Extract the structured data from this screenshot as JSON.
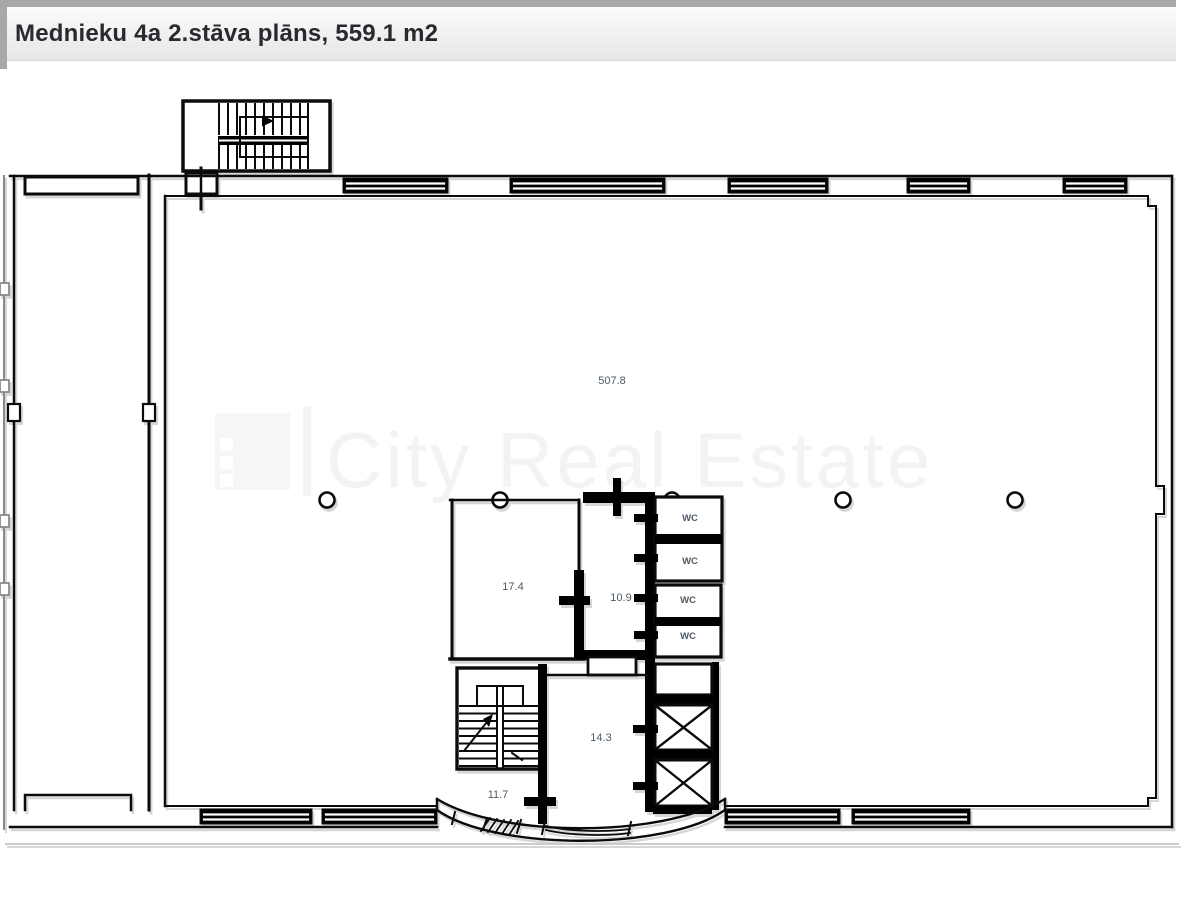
{
  "header": {
    "title": "Mednieku 4a 2.stāva plāns, 559.1 m2"
  },
  "watermark": {
    "brand": "City Real Estate",
    "logo": "city-real-estate-logo"
  },
  "plan": {
    "areas": {
      "main_hall": "507.8",
      "office": "17.4",
      "lobby": "10.9",
      "wc": "WC",
      "hall": "14.3",
      "entry": "11.7"
    }
  },
  "colors": {
    "line": "#000000",
    "label": "#4e5a66",
    "frame_gray": "#a8a8a8",
    "header_bg_top": "#fbfbfb",
    "header_bg_bottom": "#e6e6e6",
    "watermark": "#f3f3f3",
    "shadow": "#d6d6d6"
  }
}
